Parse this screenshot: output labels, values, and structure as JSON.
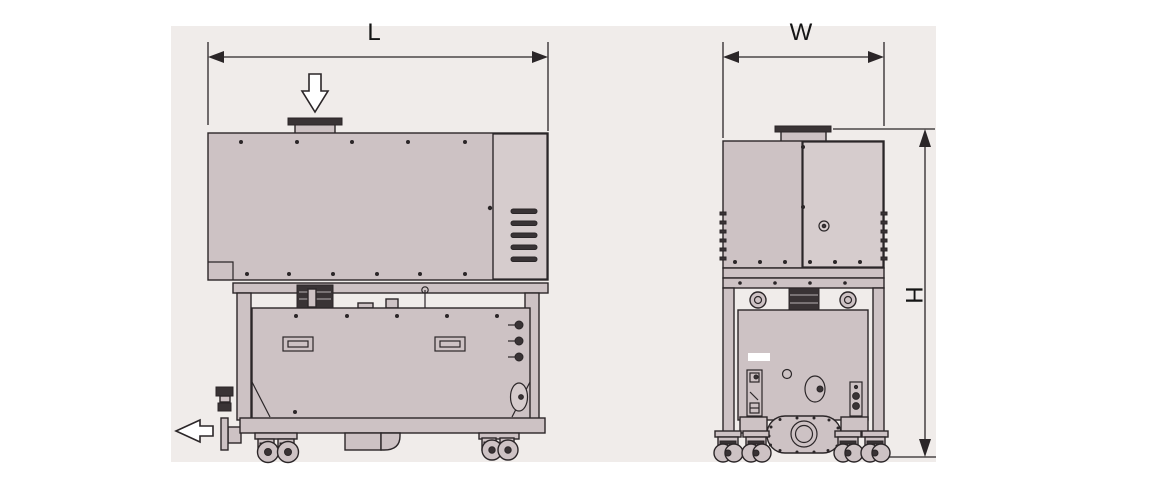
{
  "diagram": {
    "type": "technical-dimension-drawing",
    "subject": "industrial pump unit, side and front elevation views",
    "labels": {
      "length": "L",
      "width": "W",
      "height": "H"
    },
    "icons": {
      "inlet_flow_icon": "hollow-down-arrow",
      "outlet_flow_icon": "hollow-left-arrow",
      "dimension_arrowheads": "filled-triangles"
    },
    "colors": {
      "canvas": "#f0ecea",
      "panel": "#cdc2c4",
      "panel_light": "#d6cccd",
      "dark": "#393335",
      "line": "#2b2628",
      "white": "#ffffff"
    }
  }
}
